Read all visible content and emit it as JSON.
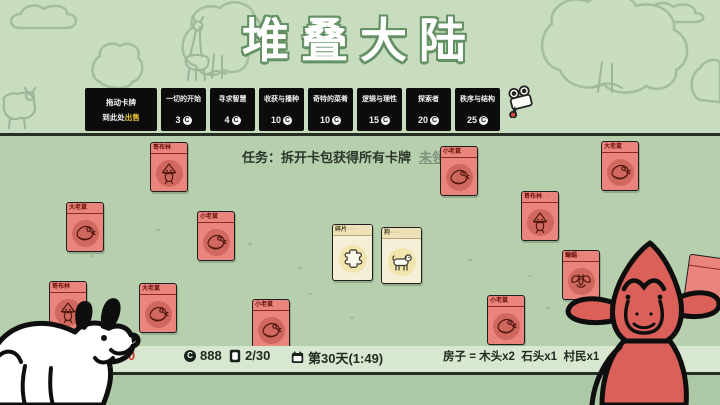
{
  "title": "堆叠大陆",
  "top_bar": {
    "sell_box": {
      "line1": "拖动卡牌",
      "line2": "到此处",
      "highlight": "出售"
    },
    "packs": [
      {
        "name": "一切的开始",
        "price": "3"
      },
      {
        "name": "寻求智慧",
        "price": "4"
      },
      {
        "name": "收获与播种",
        "price": "10"
      },
      {
        "name": "奇特的菜肴",
        "price": "10"
      },
      {
        "name": "逻辑与理性",
        "price": "15"
      },
      {
        "name": "探索者",
        "price": "20"
      },
      {
        "name": "秩序与结构",
        "price": "25"
      }
    ]
  },
  "quest": {
    "label": "任务：拆开卡包获得所有卡牌",
    "status": "未领取"
  },
  "cards": [
    {
      "name": "哥布林",
      "type": "goblin",
      "style": "red",
      "x": 150,
      "y": 142
    },
    {
      "name": "大老鼠",
      "type": "rat",
      "style": "red",
      "x": 66,
      "y": 202
    },
    {
      "name": "小老鼠",
      "type": "rat",
      "style": "red",
      "x": 197,
      "y": 211
    },
    {
      "name": "哥布林",
      "type": "goblin",
      "style": "red",
      "x": 49,
      "y": 281
    },
    {
      "name": "大老鼠",
      "type": "rat",
      "style": "red",
      "x": 139,
      "y": 283
    },
    {
      "name": "小老鼠",
      "type": "rat",
      "style": "red",
      "x": 252,
      "y": 299
    },
    {
      "name": "碎片",
      "type": "puzzle",
      "style": "beige",
      "x": 332,
      "y": 224,
      "pips": "···"
    },
    {
      "name": "狗",
      "type": "dog",
      "style": "beige",
      "x": 381,
      "y": 227,
      "pips": "····"
    },
    {
      "name": "小老鼠",
      "type": "rat",
      "style": "red",
      "x": 440,
      "y": 146
    },
    {
      "name": "大老鼠",
      "type": "rat",
      "style": "red",
      "x": 601,
      "y": 141
    },
    {
      "name": "哥布林",
      "type": "goblin",
      "style": "red",
      "x": 521,
      "y": 191,
      "pips": "···"
    },
    {
      "name": "蝙蝠",
      "type": "bat",
      "style": "red",
      "x": 562,
      "y": 250,
      "pips": "··"
    },
    {
      "name": "小老鼠",
      "type": "rat",
      "style": "red",
      "x": 487,
      "y": 295
    },
    {
      "name": "",
      "type": "hidden",
      "style": "red",
      "x": 686,
      "y": 256,
      "rot": 8
    }
  ],
  "status_bar": {
    "food": "3/0",
    "coins": "888",
    "coin_letter": "C",
    "card_count": "2/30",
    "day": "第30天(1:49)",
    "recipe": "房子 = 木头x2  石头x1  村民x1"
  },
  "icons": {
    "camera": "video-camera-icon",
    "coin": "coin-icon",
    "food": "food-icon",
    "card_stack": "card-stack-icon",
    "calendar": "calendar-icon",
    "cardopedia": "cardopedia-book-icon"
  },
  "colors": {
    "background_top": "#c8dcc0",
    "board": "#b6d0ae",
    "status_bar": "#d8e8d0",
    "pack_box": "#0c0c0c",
    "card_red": "#e9857d",
    "card_beige": "#f5efd8",
    "highlight_yellow": "#e9c53a",
    "alert_red": "#cf3a30",
    "title_outline": "#639163"
  }
}
